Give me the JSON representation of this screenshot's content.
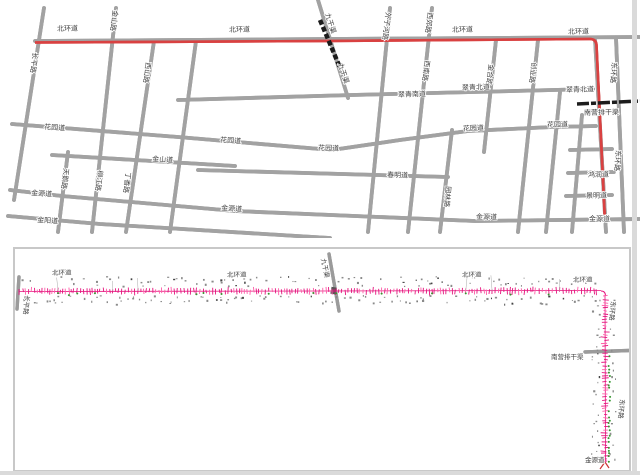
{
  "document": {
    "description_top": "city street map with highlighted red route",
    "description_bottom": "pipeline survey strip drawing along ring roads"
  },
  "colors": {
    "road_outline": "#a2a2a2",
    "road_fill": "#ffffff",
    "route_red": "#d94141",
    "rail_black": "#1c1c1c",
    "frame_gray": "#c8c8c8",
    "band_magenta": "#e5137d",
    "band_magenta_light": "#ff5ca8",
    "band_green": "#35962f",
    "speck_gray": "#8a8a8a",
    "label_color": "#3f3f3f"
  },
  "top_map": {
    "labels": [
      {
        "text": "北环道",
        "x": 57,
        "y": 31,
        "rot": -1
      },
      {
        "text": "北环道",
        "x": 229,
        "y": 32,
        "rot": -1
      },
      {
        "text": "北环道",
        "x": 452,
        "y": 32,
        "rot": -1
      },
      {
        "text": "北环道",
        "x": 568,
        "y": 34,
        "rot": -1
      },
      {
        "text": "九干渠",
        "x": 325,
        "y": 14,
        "rot": 72,
        "v": true
      },
      {
        "text": "九干渠",
        "x": 338,
        "y": 64,
        "rot": 72,
        "v": true
      },
      {
        "text": "外子河路",
        "x": 386,
        "y": 12,
        "rot": 97,
        "v": true
      },
      {
        "text": "西郊路",
        "x": 428,
        "y": 12,
        "rot": 97,
        "v": true
      },
      {
        "text": "长平路",
        "x": 33,
        "y": 52,
        "rot": 97,
        "v": true
      },
      {
        "text": "金山路",
        "x": 113,
        "y": 10,
        "rot": 97,
        "v": true
      },
      {
        "text": "西山路",
        "x": 146,
        "y": 62,
        "rot": 97,
        "v": true
      },
      {
        "text": "西南路",
        "x": 425,
        "y": 60,
        "rot": 97,
        "v": true
      },
      {
        "text": "金合路",
        "x": 489,
        "y": 64,
        "rot": 97,
        "v": true
      },
      {
        "text": "创业路",
        "x": 532,
        "y": 62,
        "rot": 97,
        "v": true
      },
      {
        "text": "东环路",
        "x": 612,
        "y": 62,
        "rot": 94,
        "v": true
      },
      {
        "text": "东环路",
        "x": 616,
        "y": 150,
        "rot": 94,
        "v": true
      },
      {
        "text": "园林路",
        "x": 446,
        "y": 186,
        "rot": 95,
        "v": true
      },
      {
        "text": "天鹅路",
        "x": 64,
        "y": 168,
        "rot": 97,
        "v": true
      },
      {
        "text": "柳江路",
        "x": 98,
        "y": 170,
        "rot": 97,
        "v": true
      },
      {
        "text": "丁香路",
        "x": 126,
        "y": 172,
        "rot": 97,
        "v": true
      },
      {
        "text": "翠青南道",
        "x": 398,
        "y": 97,
        "rot": -2
      },
      {
        "text": "翠青北道",
        "x": 462,
        "y": 90,
        "rot": -2
      },
      {
        "text": "翠青北道",
        "x": 566,
        "y": 92,
        "rot": -1
      },
      {
        "text": "南营排干渠",
        "x": 584,
        "y": 115,
        "rot": -1
      },
      {
        "text": "花园道",
        "x": 44,
        "y": 129,
        "rot": 4
      },
      {
        "text": "花园道",
        "x": 220,
        "y": 142,
        "rot": 4
      },
      {
        "text": "花园道",
        "x": 318,
        "y": 150,
        "rot": 2
      },
      {
        "text": "花园道",
        "x": 463,
        "y": 131,
        "rot": -3
      },
      {
        "text": "花园道",
        "x": 547,
        "y": 127,
        "rot": -1
      },
      {
        "text": "金山道",
        "x": 152,
        "y": 161,
        "rot": 4
      },
      {
        "text": "春明道",
        "x": 387,
        "y": 177,
        "rot": 2
      },
      {
        "text": "金源道",
        "x": 31,
        "y": 195,
        "rot": 4
      },
      {
        "text": "金源道",
        "x": 221,
        "y": 210,
        "rot": 4
      },
      {
        "text": "金源道",
        "x": 476,
        "y": 219,
        "rot": 1
      },
      {
        "text": "金源道",
        "x": 589,
        "y": 221,
        "rot": 0
      },
      {
        "text": "金阳道",
        "x": 37,
        "y": 222,
        "rot": 4
      },
      {
        "text": "鸿润道",
        "x": 588,
        "y": 177,
        "rot": -1
      },
      {
        "text": "景明道",
        "x": 586,
        "y": 198,
        "rot": -1
      }
    ]
  },
  "bottom_panel": {
    "labels": [
      {
        "text": "北环道",
        "x": 37,
        "y": 26,
        "rot": -1
      },
      {
        "text": "北环道",
        "x": 212,
        "y": 28,
        "rot": -1
      },
      {
        "text": "北环道",
        "x": 447,
        "y": 28,
        "rot": -1
      },
      {
        "text": "北环道",
        "x": 558,
        "y": 33,
        "rot": -1
      },
      {
        "text": "九干渠",
        "x": 306,
        "y": 10,
        "rot": 78,
        "v": true
      },
      {
        "text": "长平路",
        "x": 10,
        "y": 46,
        "rot": 95,
        "v": true
      },
      {
        "text": "东环路",
        "x": 596,
        "y": 52,
        "rot": 95,
        "v": true
      },
      {
        "text": "东环路",
        "x": 605,
        "y": 150,
        "rot": 95,
        "v": true
      },
      {
        "text": "南营排干渠",
        "x": 536,
        "y": 110,
        "rot": 0
      },
      {
        "text": "金源道",
        "x": 570,
        "y": 213,
        "rot": 0
      }
    ]
  }
}
